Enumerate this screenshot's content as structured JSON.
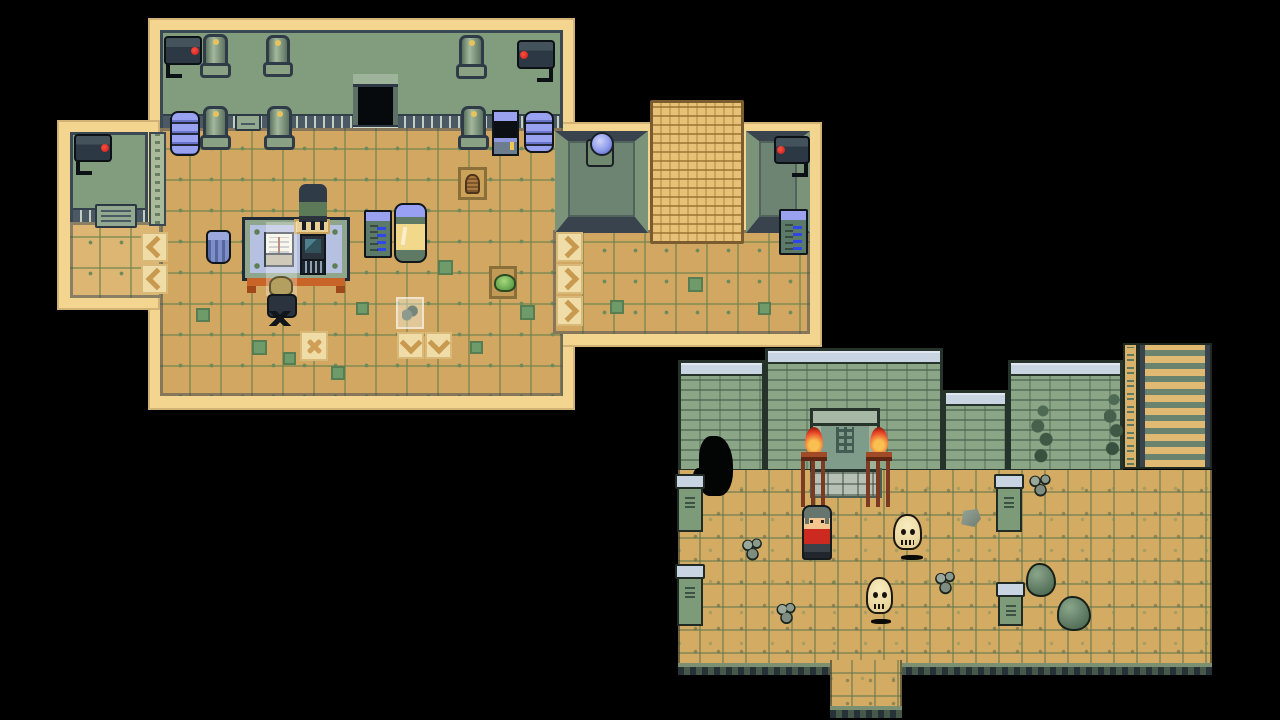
{
  "app": {
    "name": "pixel-rpg-game-screen",
    "scene": "two overworld map views on black letterbox",
    "visible_text": []
  },
  "palette": {
    "background": "#000000",
    "lab_outline_cream": "#f3d590",
    "lab_wall_green": "#829c7e",
    "lab_floor_tan": "#d2a761",
    "dark_trim": "#3a4854",
    "machine_blue": "#98a2f0",
    "capsule_window_yellow": "#f2d88a",
    "courtyard_wall_green": "#8ba687",
    "courtyard_cap_blue": "#c9d4e3",
    "courtyard_floor_tan": "#d4ab63",
    "flame_red": "#dd3a22",
    "npc_shirt_red": "#cc2a20",
    "skull_cream": "#f2e4b2"
  },
  "maps": [
    {
      "id": "lab-interior",
      "label": "laboratory interior map",
      "sprites": [
        {
          "type": "cream-base",
          "name": "lab-outline-main",
          "x": 148,
          "y": 18,
          "w": 427,
          "h": 392
        },
        {
          "type": "cream-base",
          "name": "lab-outline-wing",
          "x": 57,
          "y": 120,
          "w": 103,
          "h": 190
        },
        {
          "type": "cream-base",
          "name": "lab-outline-annex",
          "x": 555,
          "y": 122,
          "w": 267,
          "h": 225
        },
        {
          "type": "lab-wall",
          "name": "lab-back-wall",
          "x": 160,
          "y": 30,
          "w": 403,
          "h": 98
        },
        {
          "type": "lab-door",
          "name": "lab-doorway",
          "x": 353,
          "y": 74,
          "w": 45,
          "h": 62,
          "i": true
        },
        {
          "type": "lab-floor",
          "name": "lab-floor-main",
          "x": 160,
          "y": 128,
          "w": 403,
          "h": 268
        },
        {
          "type": "lab-wall",
          "name": "wing-back-wall",
          "x": 70,
          "y": 132,
          "w": 78,
          "h": 90
        },
        {
          "type": "lab-floor light",
          "name": "wing-floor",
          "x": 70,
          "y": 222,
          "w": 92,
          "h": 76
        },
        {
          "type": "pillar-col",
          "name": "wing-corner-pillar",
          "x": 149,
          "y": 132,
          "w": 17,
          "h": 94
        },
        {
          "type": "plaque",
          "name": "wing-vent-grille",
          "x": 95,
          "y": 204,
          "w": 42,
          "h": 24
        },
        {
          "type": "cam-r",
          "name": "security-camera-icon",
          "x": 74,
          "y": 134,
          "w": 38,
          "h": 28
        },
        {
          "type": "lab-floor",
          "name": "annex-floor",
          "x": 553,
          "y": 230,
          "w": 257,
          "h": 104
        },
        {
          "type": "alcove",
          "name": "annex-alcove-left",
          "x": 555,
          "y": 131,
          "w": 93,
          "h": 102
        },
        {
          "type": "alcove",
          "name": "annex-alcove-right",
          "x": 746,
          "y": 131,
          "w": 64,
          "h": 102
        },
        {
          "type": "mat",
          "name": "woven-mat",
          "x": 650,
          "y": 100,
          "w": 94,
          "h": 144
        },
        {
          "type": "orb-machine",
          "name": "orb-machine",
          "x": 586,
          "y": 139,
          "w": 28,
          "h": 28,
          "i": true
        },
        {
          "type": "cam-l",
          "name": "security-camera-icon",
          "x": 774,
          "y": 136,
          "w": 36,
          "h": 28
        },
        {
          "type": "server",
          "name": "server-tower",
          "x": 779,
          "y": 209,
          "w": 29,
          "h": 46,
          "i": true
        },
        {
          "type": "pipe",
          "name": "wall-pipe",
          "x": 203,
          "y": 34,
          "w": 25,
          "h": 44
        },
        {
          "type": "pipe",
          "name": "wall-pipe",
          "x": 266,
          "y": 35,
          "w": 24,
          "h": 42
        },
        {
          "type": "pipe",
          "name": "wall-pipe",
          "x": 459,
          "y": 35,
          "w": 25,
          "h": 44
        },
        {
          "type": "pipe",
          "name": "floor-pipe",
          "x": 203,
          "y": 106,
          "w": 25,
          "h": 44
        },
        {
          "type": "pipe",
          "name": "floor-pipe",
          "x": 267,
          "y": 106,
          "w": 25,
          "h": 44
        },
        {
          "type": "pipe",
          "name": "floor-pipe",
          "x": 461,
          "y": 106,
          "w": 25,
          "h": 44
        },
        {
          "type": "plaque",
          "name": "wall-vent",
          "x": 235,
          "y": 114,
          "w": 26,
          "h": 17
        },
        {
          "type": "disc-stack",
          "name": "disc-stack-machine",
          "x": 170,
          "y": 111,
          "w": 30,
          "h": 45,
          "i": true
        },
        {
          "type": "disc-stack",
          "name": "disc-stack-machine",
          "x": 524,
          "y": 111,
          "w": 30,
          "h": 42,
          "i": true
        },
        {
          "type": "kiosk",
          "name": "console-machine",
          "x": 492,
          "y": 110,
          "w": 27,
          "h": 46,
          "i": true
        },
        {
          "type": "cam-r",
          "name": "security-camera-icon",
          "x": 164,
          "y": 36,
          "w": 38,
          "h": 29
        },
        {
          "type": "cam-l",
          "name": "security-camera-icon",
          "x": 517,
          "y": 40,
          "w": 38,
          "h": 29
        },
        {
          "type": "basket-tile",
          "name": "floor-hatch-basket",
          "x": 458,
          "y": 167,
          "w": 29,
          "h": 33
        },
        {
          "type": "slime-tile",
          "name": "floor-hatch-plant",
          "x": 489,
          "y": 266,
          "w": 28,
          "h": 33
        },
        {
          "type": "arrow left",
          "name": "conveyor-arrow-left",
          "x": 141,
          "y": 232,
          "w": 27,
          "h": 30,
          "i": true
        },
        {
          "type": "arrow left",
          "name": "conveyor-arrow-left",
          "x": 141,
          "y": 264,
          "w": 27,
          "h": 30,
          "i": true
        },
        {
          "type": "arrow right",
          "name": "conveyor-arrow-right",
          "x": 556,
          "y": 232,
          "w": 27,
          "h": 30,
          "i": true
        },
        {
          "type": "arrow right",
          "name": "conveyor-arrow-right",
          "x": 556,
          "y": 264,
          "w": 27,
          "h": 30,
          "i": true
        },
        {
          "type": "arrow right",
          "name": "conveyor-arrow-right",
          "x": 556,
          "y": 296,
          "w": 27,
          "h": 30,
          "i": true
        },
        {
          "type": "arrow down",
          "name": "conveyor-arrow-down",
          "x": 397,
          "y": 332,
          "w": 27,
          "h": 27,
          "i": true
        },
        {
          "type": "arrow down",
          "name": "conveyor-arrow-down",
          "x": 425,
          "y": 332,
          "w": 27,
          "h": 27,
          "i": true
        },
        {
          "type": "x-tile",
          "name": "cross-marked-tile",
          "x": 300,
          "y": 331,
          "w": 28,
          "h": 30
        },
        {
          "type": "accent",
          "name": "floor-accent-tile",
          "x": 196,
          "y": 308,
          "w": 14,
          "h": 14
        },
        {
          "type": "accent",
          "name": "floor-accent-tile",
          "x": 252,
          "y": 340,
          "w": 15,
          "h": 15
        },
        {
          "type": "accent",
          "name": "floor-accent-tile",
          "x": 283,
          "y": 352,
          "w": 13,
          "h": 13
        },
        {
          "type": "accent",
          "name": "floor-accent-tile",
          "x": 331,
          "y": 366,
          "w": 14,
          "h": 14
        },
        {
          "type": "accent",
          "name": "floor-accent-tile",
          "x": 356,
          "y": 302,
          "w": 13,
          "h": 13
        },
        {
          "type": "accent",
          "name": "floor-accent-tile",
          "x": 438,
          "y": 260,
          "w": 15,
          "h": 15
        },
        {
          "type": "accent",
          "name": "floor-accent-tile",
          "x": 470,
          "y": 341,
          "w": 13,
          "h": 13
        },
        {
          "type": "accent",
          "name": "floor-accent-tile",
          "x": 520,
          "y": 305,
          "w": 15,
          "h": 15
        },
        {
          "type": "accent",
          "name": "floor-accent-tile",
          "x": 610,
          "y": 300,
          "w": 14,
          "h": 14
        },
        {
          "type": "accent",
          "name": "floor-accent-tile",
          "x": 688,
          "y": 277,
          "w": 15,
          "h": 15
        },
        {
          "type": "accent",
          "name": "floor-accent-tile",
          "x": 758,
          "y": 302,
          "w": 13,
          "h": 13
        },
        {
          "type": "trash",
          "name": "trash-bin",
          "x": 206,
          "y": 230,
          "w": 25,
          "h": 34,
          "i": true
        },
        {
          "type": "desk",
          "name": "lab-desk",
          "x": 242,
          "y": 217,
          "w": 108,
          "h": 64,
          "i": true
        },
        {
          "type": "pad",
          "name": "chair-mat-tile",
          "x": 294,
          "y": 219,
          "w": 36,
          "h": 15
        },
        {
          "type": "chair-n",
          "name": "desk-chair-back",
          "x": 299,
          "y": 184,
          "w": 28,
          "h": 50,
          "i": true
        },
        {
          "type": "book",
          "name": "open-book",
          "x": 264,
          "y": 232,
          "w": 30,
          "h": 26,
          "i": true
        },
        {
          "type": "computer",
          "name": "desktop-computer",
          "x": 300,
          "y": 234,
          "w": 26,
          "h": 30,
          "i": true
        },
        {
          "type": "light-beam",
          "name": "light-overlay",
          "x": 266,
          "y": 222,
          "w": 31,
          "h": 74
        },
        {
          "type": "sack",
          "name": "sack",
          "x": 269,
          "y": 276,
          "w": 24,
          "h": 20
        },
        {
          "type": "chair-s",
          "name": "office-chair",
          "x": 263,
          "y": 294,
          "w": 34,
          "h": 36,
          "i": true
        },
        {
          "type": "server",
          "name": "server-tower",
          "x": 364,
          "y": 210,
          "w": 28,
          "h": 48,
          "i": true
        },
        {
          "type": "capsule",
          "name": "capsule-machine",
          "x": 394,
          "y": 203,
          "w": 33,
          "h": 60,
          "i": true
        },
        {
          "type": "rock-tile",
          "name": "highlighted-rubble-tile",
          "x": 396,
          "y": 297,
          "w": 28,
          "h": 32
        }
      ]
    },
    {
      "id": "temple-courtyard",
      "label": "temple courtyard map",
      "sprites": [
        {
          "type": "wall-sec",
          "name": "courtyard-wall",
          "x": 678,
          "y": 360,
          "w": 87,
          "h": 112
        },
        {
          "type": "wall-sec",
          "name": "courtyard-wall-raised",
          "x": 765,
          "y": 348,
          "w": 178,
          "h": 124
        },
        {
          "type": "wall-sec",
          "name": "courtyard-wall-notch",
          "x": 943,
          "y": 390,
          "w": 65,
          "h": 82
        },
        {
          "type": "wall-sec",
          "name": "courtyard-wall",
          "x": 1008,
          "y": 360,
          "w": 115,
          "h": 112
        },
        {
          "type": "glyph-col",
          "name": "glyph-column",
          "x": 1123,
          "y": 343,
          "w": 15,
          "h": 126
        },
        {
          "type": "ladder",
          "name": "stairway",
          "x": 1138,
          "y": 343,
          "w": 74,
          "h": 126,
          "i": true
        },
        {
          "type": "cy-floor",
          "name": "courtyard-floor",
          "x": 678,
          "y": 470,
          "w": 534,
          "h": 205
        },
        {
          "type": "cy-floor",
          "name": "courtyard-floor-exit",
          "x": 830,
          "y": 660,
          "w": 72,
          "h": 58,
          "i": true
        },
        {
          "type": "threshold",
          "name": "door-threshold",
          "x": 810,
          "y": 468,
          "w": 72,
          "h": 30
        },
        {
          "type": "cave-hole",
          "name": "wall-breach",
          "x": 699,
          "y": 436,
          "w": 34,
          "h": 60,
          "i": true
        },
        {
          "type": "cy-door",
          "name": "temple-door",
          "x": 810,
          "y": 408,
          "w": 70,
          "h": 64,
          "i": true
        },
        {
          "type": "vine",
          "name": "wall-vine",
          "x": 1030,
          "y": 403,
          "w": 26,
          "h": 66
        },
        {
          "type": "vine",
          "name": "wall-vine",
          "x": 1104,
          "y": 391,
          "w": 20,
          "h": 72
        },
        {
          "type": "debris",
          "name": "rubble-pile",
          "x": 1027,
          "y": 473,
          "w": 27,
          "h": 24
        },
        {
          "type": "pillar",
          "name": "stone-pillar",
          "x": 677,
          "y": 474,
          "w": 26,
          "h": 58
        },
        {
          "type": "pillar",
          "name": "stone-pillar",
          "x": 677,
          "y": 564,
          "w": 26,
          "h": 62
        },
        {
          "type": "pillar",
          "name": "stone-pillar",
          "x": 996,
          "y": 474,
          "w": 26,
          "h": 58
        },
        {
          "type": "pillar",
          "name": "stone-pillar",
          "x": 998,
          "y": 582,
          "w": 25,
          "h": 44
        },
        {
          "type": "torch",
          "name": "flaming-brazier",
          "x": 799,
          "y": 427,
          "w": 30,
          "h": 80
        },
        {
          "type": "torch",
          "name": "flaming-brazier",
          "x": 864,
          "y": 427,
          "w": 30,
          "h": 80
        },
        {
          "type": "shadow",
          "name": "skull-shadow",
          "x": 901,
          "y": 555,
          "w": 22,
          "h": 5
        },
        {
          "type": "skull",
          "name": "floating-skull",
          "x": 893,
          "y": 514,
          "w": 29,
          "h": 36,
          "i": true
        },
        {
          "type": "shadow",
          "name": "skull-shadow",
          "x": 871,
          "y": 619,
          "w": 20,
          "h": 5
        },
        {
          "type": "skull",
          "name": "floating-skull",
          "x": 866,
          "y": 577,
          "w": 27,
          "h": 37,
          "i": true
        },
        {
          "type": "npc-red",
          "name": "player-character",
          "x": 802,
          "y": 505,
          "w": 30,
          "h": 55,
          "i": true
        },
        {
          "type": "debris",
          "name": "rubble-pile",
          "x": 741,
          "y": 537,
          "w": 23,
          "h": 24
        },
        {
          "type": "debris",
          "name": "rubble-pile",
          "x": 776,
          "y": 602,
          "w": 21,
          "h": 22
        },
        {
          "type": "debris",
          "name": "rubble-pile",
          "x": 934,
          "y": 570,
          "w": 23,
          "h": 25
        },
        {
          "type": "stone",
          "name": "stone-block",
          "x": 959,
          "y": 509,
          "w": 22,
          "h": 18
        },
        {
          "type": "boulder",
          "name": "boulder",
          "x": 1026,
          "y": 563,
          "w": 30,
          "h": 34
        },
        {
          "type": "boulder",
          "name": "boulder",
          "x": 1057,
          "y": 596,
          "w": 34,
          "h": 35
        }
      ]
    }
  ]
}
